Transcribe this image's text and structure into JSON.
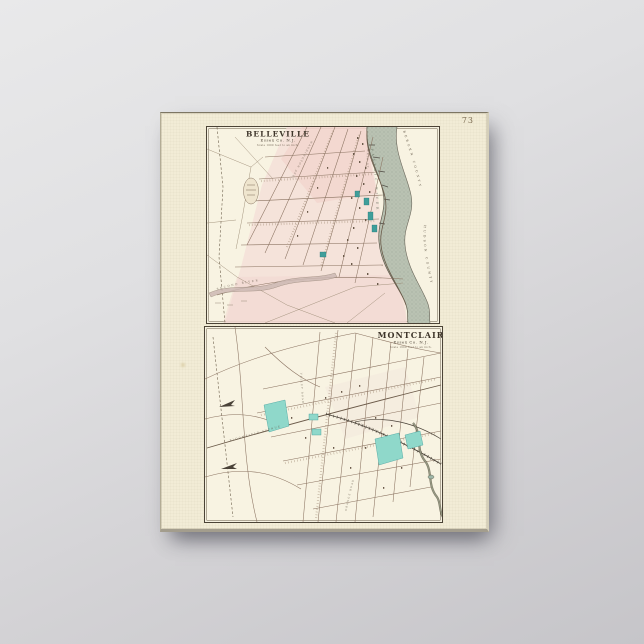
{
  "artwork": {
    "page_number": "73",
    "belleville": {
      "title": "BELLEVILLE",
      "subtitle": "Essex Co. N.J.",
      "scale_note": "Scale 1000 feet to an inch.",
      "river_label": "PASSAIC RIVER",
      "county_upper": "BERGEN COUNTY",
      "county_lower": "HUDSON COUNTY",
      "stream_label": "SECOND RIVER",
      "street_labels": [
        "WASHINGTON AVE.",
        "MAIN ST."
      ]
    },
    "montclair": {
      "title": "MONTCLAIR",
      "subtitle": "Essex Co. N.J.",
      "scale_note": "Scale 1600 feet to an inch.",
      "street_labels": [
        "BLOOMFIELD AVENUE",
        "VALLEY ROAD",
        "ORANGE ROAD"
      ],
      "railroad_label": "RAIL ROAD"
    },
    "colors": {
      "wall": "#d4d3d6",
      "paper": "#f2ecd6",
      "map_background": "#f8f3e2",
      "town_pink": "#f3d9d3",
      "teal_dark": "#3f9e9a",
      "teal_light": "#8fd8ca",
      "river_gray_green": "#b9c2b2",
      "ink": "#4b4336"
    }
  }
}
